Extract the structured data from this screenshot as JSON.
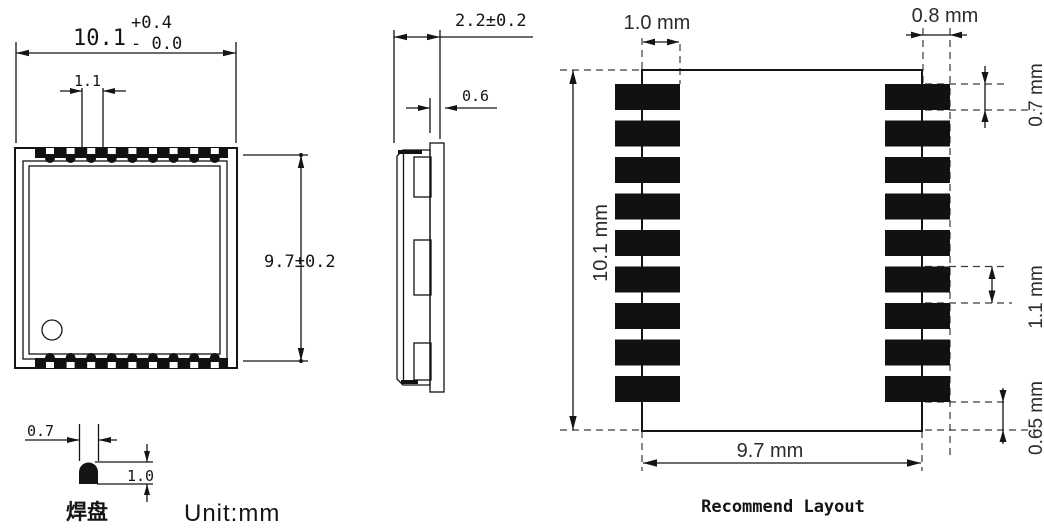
{
  "views": {
    "top": {
      "dim_width_value": "10.1",
      "dim_width_tol_plus": "+0.4",
      "dim_width_tol_minus": "- 0.0",
      "dim_pitch": "1.1",
      "dim_height": "9.7±0.2",
      "pins_per_edge": 9
    },
    "side": {
      "dim_thickness": "2.2±0.2",
      "dim_pcb_thickness": "0.6"
    },
    "pad_detail": {
      "dim_width": "0.7",
      "dim_height": "1.0",
      "label": "焊盘"
    },
    "unit_note": "Unit:mm",
    "layout": {
      "title": "Recommend Layout",
      "dim_pad_inner": "1.0 mm",
      "dim_pad_outer": "0.8 mm",
      "dim_pad_height": "0.7 mm",
      "dim_body_height": "10.1 mm",
      "dim_pad_pitch": "1.1 mm",
      "dim_bottom_gap": "0.65 mm",
      "dim_body_width": "9.7 mm",
      "pads_per_side": 9
    }
  }
}
